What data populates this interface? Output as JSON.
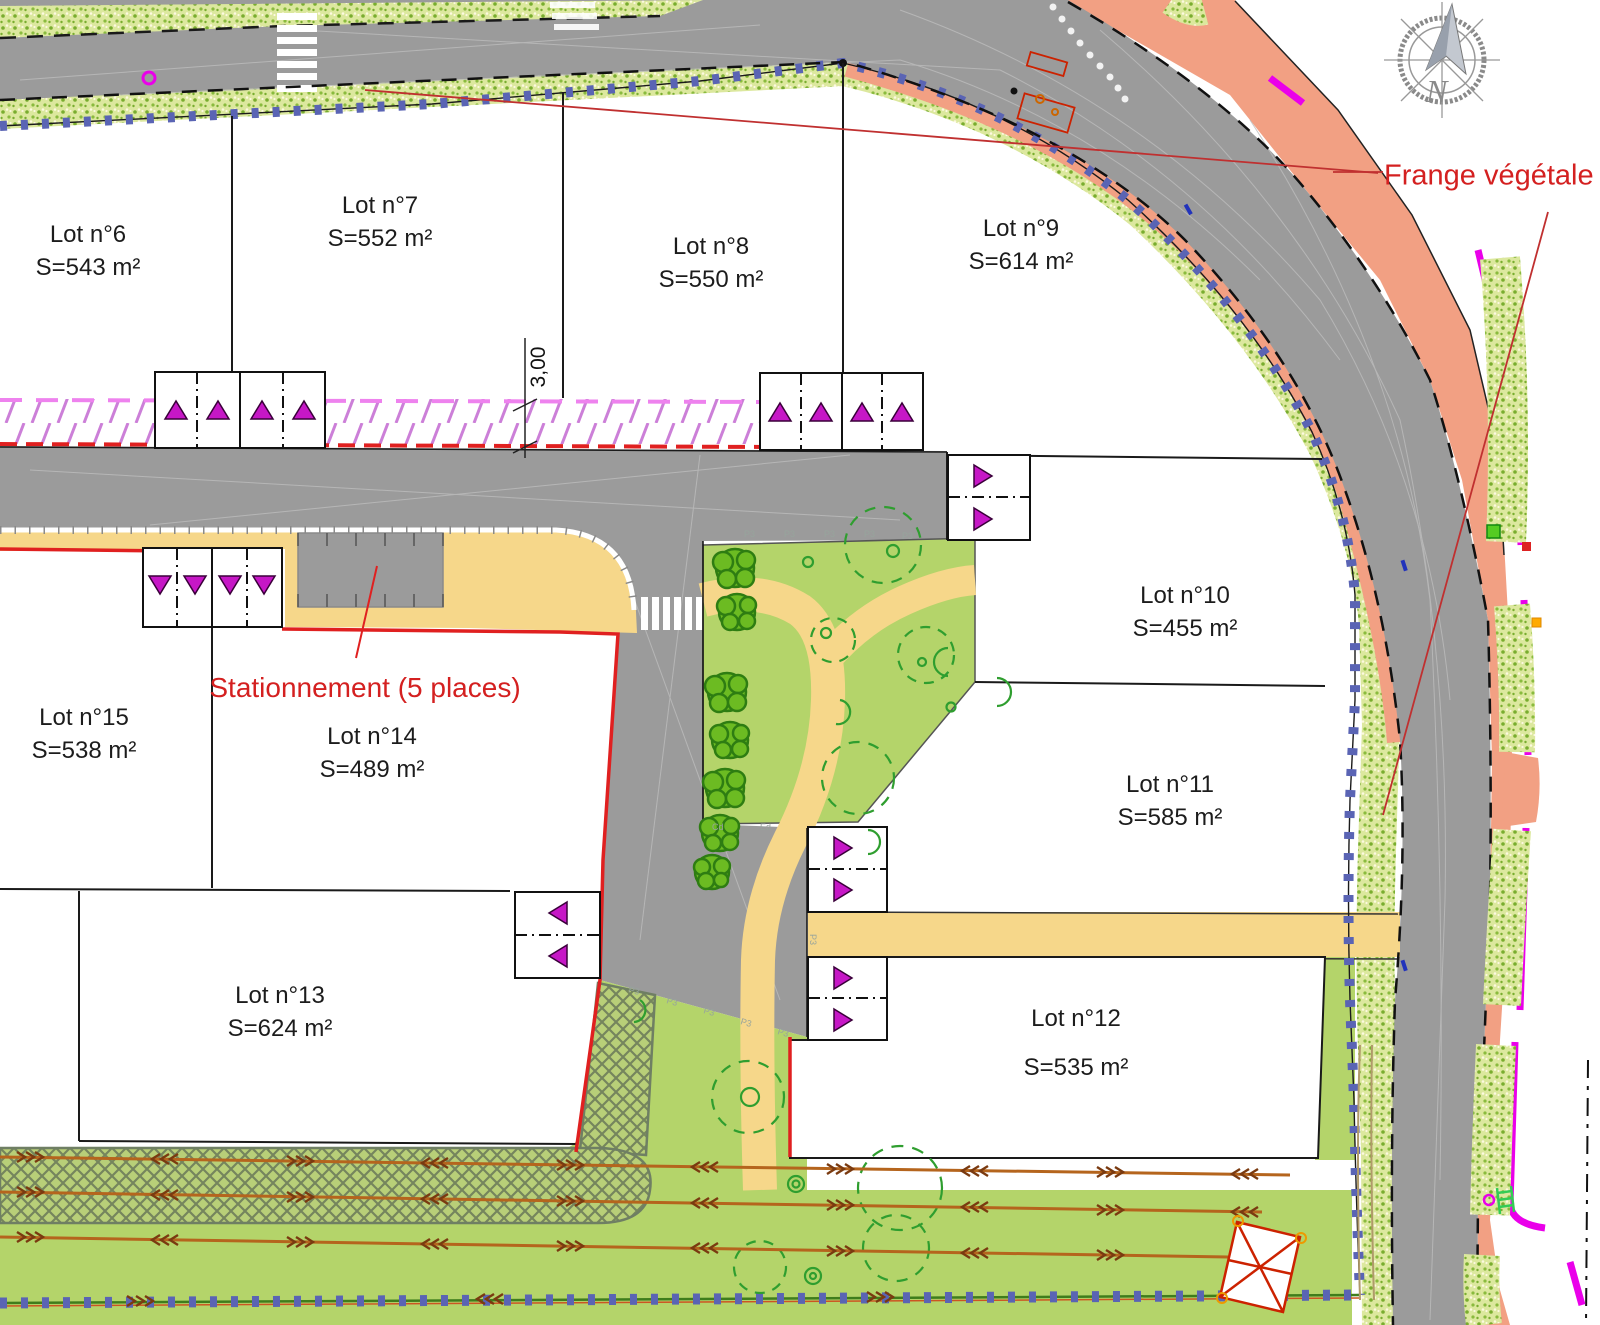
{
  "plan": {
    "lots": [
      {
        "id": "6",
        "name": "Lot n°6",
        "area": "S=543 m²"
      },
      {
        "id": "7",
        "name": "Lot n°7",
        "area": "S=552 m²"
      },
      {
        "id": "8",
        "name": "Lot n°8",
        "area": "S=550 m²"
      },
      {
        "id": "9",
        "name": "Lot n°9",
        "area": "S=614 m²"
      },
      {
        "id": "10",
        "name": "Lot n°10",
        "area": "S=455 m²"
      },
      {
        "id": "11",
        "name": "Lot n°11",
        "area": "S=585 m²"
      },
      {
        "id": "12",
        "name": "Lot n°12",
        "area": "S=535 m²"
      },
      {
        "id": "13",
        "name": "Lot n°13",
        "area": "S=624 m²"
      },
      {
        "id": "14",
        "name": "Lot n°14",
        "area": "S=489 m²"
      },
      {
        "id": "15",
        "name": "Lot n°15",
        "area": "S=538 m²"
      }
    ],
    "annotations": {
      "parking": "Stationnement (5 places)",
      "vegetal_fringe": "Frange végétale",
      "dimension": "3,00",
      "north": "N",
      "p3": "P3",
      "cd": "Cd",
      "ed": "Ed"
    },
    "colors": {
      "road": "#9b9b9b",
      "salmon": "#f2a083",
      "yellow": "#f6d78a",
      "lawn": "#b4d46a",
      "vegbase": "#dce89e",
      "vegdot": "#79ad2f",
      "blue": "#5a64b4",
      "red": "#e02020",
      "violet": "#cc7fd8",
      "pink": "#ee82ee",
      "magenta": "#ea00ea",
      "tri": "#c617c6",
      "labelred": "#d42020",
      "tree": "#6cbb22",
      "treedark": "#2e7d12",
      "arrow": "#b5651d",
      "symgreen": "#2f9e2f"
    }
  }
}
